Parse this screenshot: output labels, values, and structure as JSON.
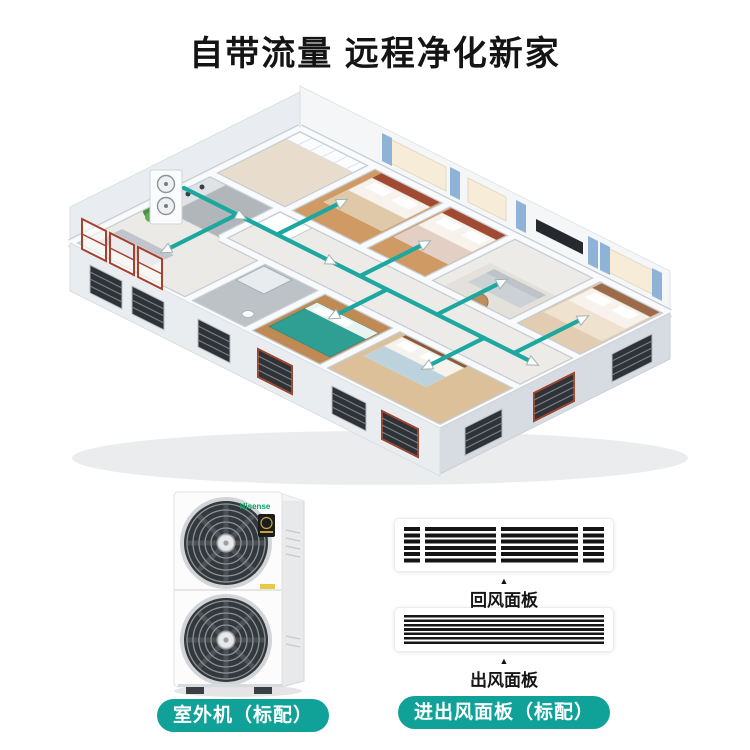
{
  "header": {
    "title": "自带流量 远程净化新家"
  },
  "theme": {
    "accent": "#10a298",
    "text": "#141414",
    "background": "#ffffff"
  },
  "illustration": {
    "duct_color": "#1ca8a0",
    "arrow_fill": "#ffffff",
    "arrow_stroke": "#9fb3b1",
    "wall_top": "#f8fafc",
    "wall_edge": "#c6ccd2",
    "shadow_color": "rgba(60,70,80,0.10)"
  },
  "products": {
    "outdoor_unit": {
      "brand": "Hisense",
      "caption": "室外机（标配）"
    },
    "panels": {
      "pointer": "▲",
      "return_caption": "回风面板",
      "outlet_caption": "出风面板",
      "caption": "进出风面板（标配）"
    }
  }
}
